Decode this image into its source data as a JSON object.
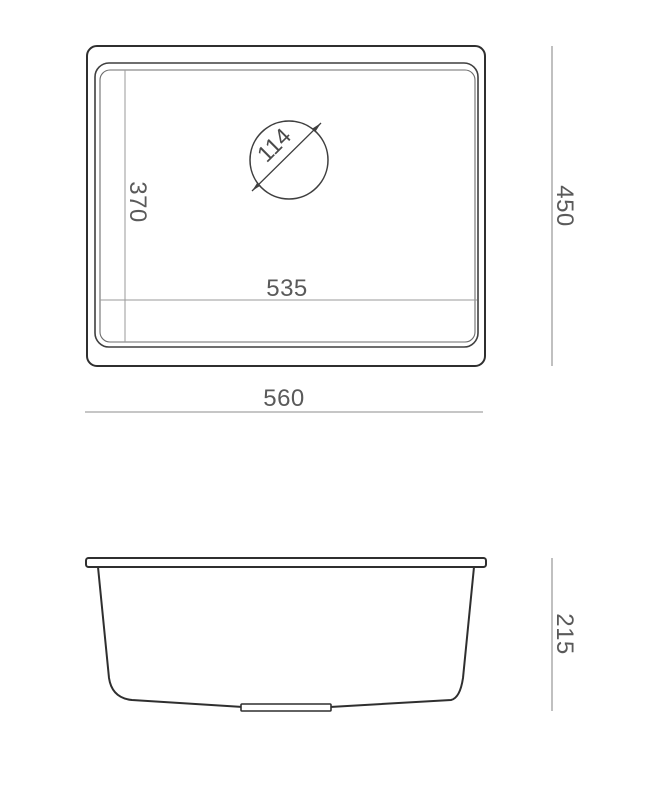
{
  "figure": {
    "type": "sink-technical-drawing",
    "views": {
      "top": {
        "outer_width": "560",
        "outer_depth": "450",
        "bowl_width": "535",
        "bowl_depth": "370",
        "drain_diameter": "114"
      },
      "side": {
        "height": "215"
      }
    }
  },
  "colors": {
    "outline": "#2f2f2f",
    "rim_edge": "#6e6e6e",
    "dimension_line": "#8c8c8c",
    "label_text": "#5a5a5a",
    "background": "#ffffff"
  }
}
